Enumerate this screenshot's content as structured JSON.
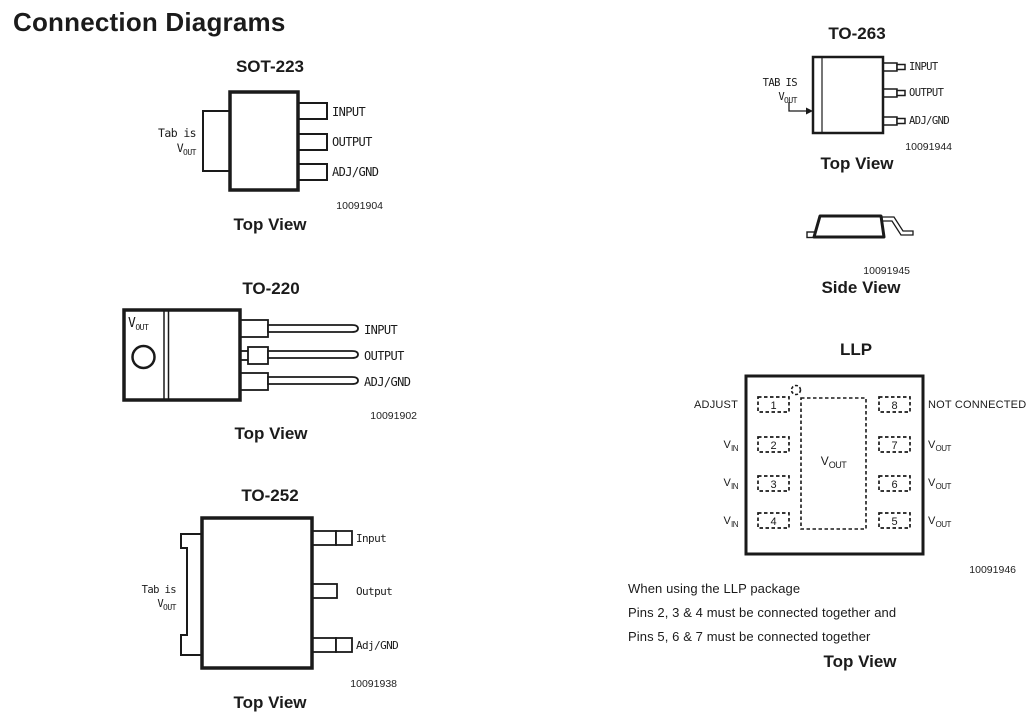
{
  "page": {
    "title": "Connection Diagrams"
  },
  "colors": {
    "ink": "#1a1a1a",
    "background": "#ffffff"
  },
  "sot223": {
    "title": "SOT-223",
    "tab_line": "Tab is",
    "v": "V",
    "v_sub": "OUT",
    "pins": [
      "INPUT",
      "OUTPUT",
      "ADJ/GND"
    ],
    "figure_number": "10091904",
    "caption": "Top View"
  },
  "to220": {
    "title": "TO-220",
    "v": "V",
    "v_sub": "OUT",
    "pins": [
      "INPUT",
      "OUTPUT",
      "ADJ/GND"
    ],
    "figure_number": "10091902",
    "caption": "Top View"
  },
  "to252": {
    "title": "TO-252",
    "tab_line": "Tab is",
    "v": "V",
    "v_sub": "OUT",
    "pins": [
      "Input",
      "Output",
      "Adj/GND"
    ],
    "figure_number": "10091938",
    "caption": "Top View"
  },
  "to263": {
    "title": "TO-263",
    "tab_line": "TAB IS",
    "v": "V",
    "v_sub": "OUT",
    "pins": [
      "INPUT",
      "OUTPUT",
      "ADJ/GND"
    ],
    "figure_number": "10091944",
    "caption": "Top View"
  },
  "sideview": {
    "figure_number": "10091945",
    "caption": "Side View"
  },
  "llp": {
    "title": "LLP",
    "pads_left": [
      "1",
      "2",
      "3",
      "4"
    ],
    "pads_right": [
      "8",
      "7",
      "6",
      "5"
    ],
    "left_labels": {
      "pin1": "ADJUST",
      "v": "V",
      "v_sub": "IN"
    },
    "right_labels": {
      "pin8": "NOT CONNECTED",
      "v": "V",
      "v_sub": "OUT"
    },
    "center_pad": {
      "v": "V",
      "v_sub": "OUT"
    },
    "figure_number": "10091946",
    "caption": "Top View",
    "notes": [
      "When using the LLP package",
      "Pins 2, 3 & 4 must be connected together and",
      "Pins 5, 6 & 7 must be connected together"
    ]
  }
}
